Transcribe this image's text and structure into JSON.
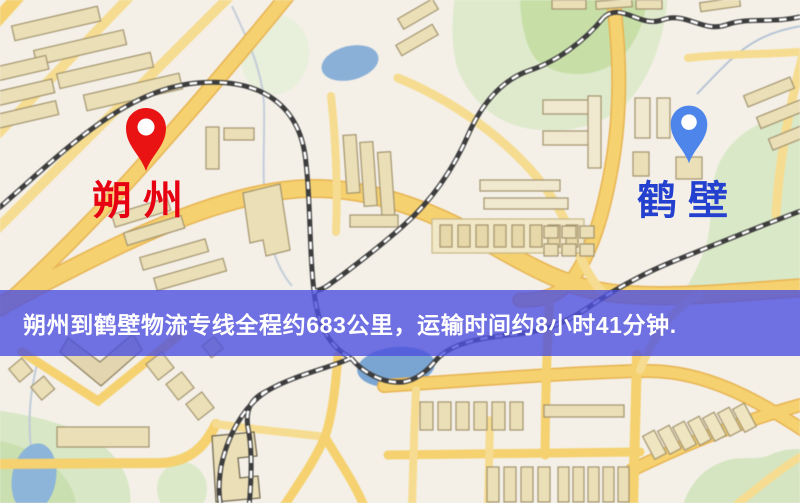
{
  "page": {
    "width": 800,
    "height": 503,
    "type": "logistics-route-map"
  },
  "banner": {
    "text": "朔州到鹤壁物流专线全程约683公里，运输时间约8小时41分钟.",
    "background": "#4d50de",
    "opacity": 0.8,
    "text_color": "#ffffff"
  },
  "route": {
    "from": "朔州",
    "to": "鹤壁",
    "distance_text": "约683公里",
    "duration_text": "约8小时41分钟"
  },
  "origin_marker": {
    "label": "朔州",
    "label_color": "#e60012",
    "pin_icon": "red-map-pin",
    "pin_color": "#e91313"
  },
  "destination_marker": {
    "label": "鹤壁",
    "label_color": "#2440cf",
    "pin_icon": "blue-map-pin",
    "pin_color": "#4d85ea"
  },
  "map_colors": {
    "background": "#f4f0e8",
    "road_major": "#f6d16c",
    "road_casing": "#e9b34e",
    "park": "#dcead0",
    "park_dark": "#c7dfa6",
    "water": "#8ab0d8",
    "railway_dark": "#3d3d3d",
    "railway_dash": "#ffffff",
    "building_fill": "#eadfb6",
    "building_stroke": "#a3936c"
  }
}
